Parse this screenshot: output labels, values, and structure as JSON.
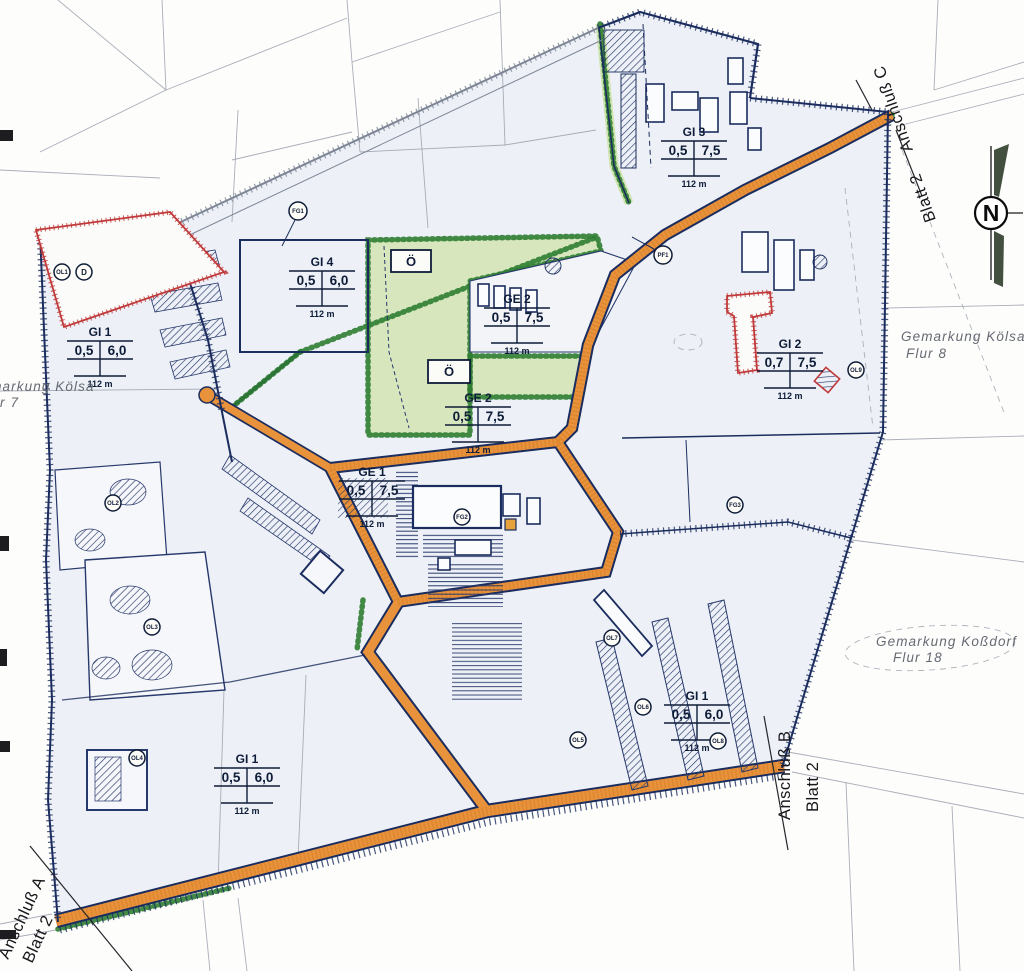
{
  "map": {
    "compass": {
      "label": "N"
    },
    "connections": {
      "a": {
        "line1": "Anschluß A",
        "line2": "Blatt 2"
      },
      "b": {
        "line1": "Anschluß B",
        "line2": "Blatt 2"
      },
      "c": {
        "line1": "Anschluß C",
        "line2": "Blatt 2"
      }
    },
    "districts": {
      "west": {
        "line1": "Gemarkung Kölsa",
        "line2": "Flur 7"
      },
      "east": {
        "line1": "Gemarkung Kölsa",
        "line2": "Flur 8"
      },
      "southeast": {
        "line1": "Gemarkung Koßdorf",
        "line2": "Flur 18"
      }
    },
    "green_area_label": "Ö",
    "zones": [
      {
        "id": "gi3",
        "name": "GI 3",
        "v1": "0,5",
        "v2": "7,5",
        "h": "112 m"
      },
      {
        "id": "gi4",
        "name": "GI 4",
        "v1": "0,5",
        "v2": "6,0",
        "h": "112 m"
      },
      {
        "id": "ge2a",
        "name": "GE 2",
        "v1": "0,5",
        "v2": "7,5",
        "h": "112 m"
      },
      {
        "id": "ge2b",
        "name": "GE 2",
        "v1": "0,5",
        "v2": "7,5",
        "h": "112 m"
      },
      {
        "id": "ge1",
        "name": "GE 1",
        "v1": "0,5",
        "v2": "7,5",
        "h": "112 m"
      },
      {
        "id": "gi1w",
        "name": "GI 1",
        "v1": "0,5",
        "v2": "6,0",
        "h": "112 m"
      },
      {
        "id": "gi2",
        "name": "GI 2",
        "v1": "0,7",
        "v2": "7,5",
        "h": "112 m"
      },
      {
        "id": "gi1s",
        "name": "GI 1",
        "v1": "0,5",
        "v2": "6,0",
        "h": "112 m"
      },
      {
        "id": "gi1e",
        "name": "GI 1",
        "v1": "0,5",
        "v2": "6,0",
        "h": "112 m"
      }
    ],
    "markers": [
      {
        "label": "OL1"
      },
      {
        "label": "D"
      },
      {
        "label": "FG1"
      },
      {
        "label": "PF1"
      },
      {
        "label": "OL9"
      },
      {
        "label": "FG3"
      },
      {
        "label": "OL2"
      },
      {
        "label": "OL3"
      },
      {
        "label": "OL4"
      },
      {
        "label": "OL5"
      },
      {
        "label": "OL6"
      },
      {
        "label": "OL7"
      },
      {
        "label": "OL8"
      },
      {
        "label": "FG2"
      }
    ],
    "colors": {
      "road": "#e8923c",
      "green": "#d7e6bd",
      "green_border": "#2f7d32",
      "boundary": "#1b2d5e",
      "red": "#c03a3a",
      "site": "#edf1f7"
    }
  }
}
